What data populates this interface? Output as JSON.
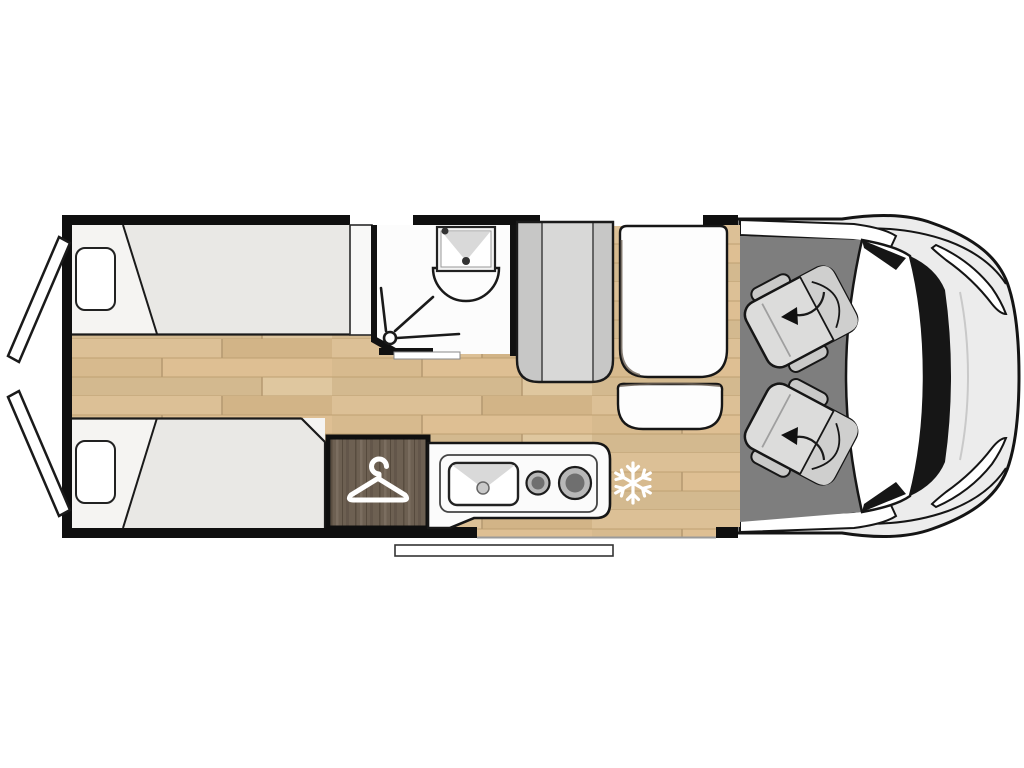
{
  "meta": {
    "title": "Campervan floor plan (top view)",
    "description": "Motorhome layout diagram: rear twin single beds with open rear doors, central bathroom with shower and washbasin, wardrobe, kitchen block with sink and two burners, fridge position marked with snowflake, side dinette bench with table, driver cab with two swivel seats and rotation arrows.",
    "visible_text": ""
  },
  "features": {
    "beds": 2,
    "pillows": 2,
    "cab_swivel_seats": 2,
    "kitchen_burners": 1,
    "burner_count": 2,
    "rear_doors_open": 2,
    "windows_top_wall": 2,
    "entry_door_bottom": 1
  },
  "icons": [
    {
      "name": "hanger-icon",
      "meaning": "wardrobe"
    },
    {
      "name": "snowflake-icon",
      "meaning": "fridge / freezer position"
    },
    {
      "name": "shower-spray-icon",
      "meaning": "shower"
    },
    {
      "name": "rotation-arrow-icon",
      "meaning": "swivelling cab seat"
    }
  ],
  "colors": {
    "wall": "#0f0f0f",
    "outline": "#1a1a1a",
    "floor_wood": "#d8bb90",
    "bed_sheet": "#f5f4f2",
    "bed_blanket": "#e9e8e5",
    "pillow": "#ffffff",
    "bath_floor": "#fcfcfc",
    "fixture_shade": "#d9d9d9",
    "bench": "#d8d8d7",
    "bench_side": "#c7c7c6",
    "table": "#fdfdfd",
    "table_shadow": "#6d6156",
    "wardrobe": "#6d6052",
    "kitchen": "#fbfbfb",
    "burner_ring": "#b8b8b8",
    "burner_core": "#6f6f6f",
    "cab_floor": "#7e7e7e",
    "seat": "#dcdcdb",
    "seat_back": "#cfcfce",
    "seat_arm": "#c9c9c8",
    "vehicle_body": "#ececec",
    "windshield": "#ffffff",
    "cowl": "#161616",
    "icon_white": "#ffffff",
    "door_panel": "#ffffff",
    "step": "#ffffff"
  }
}
